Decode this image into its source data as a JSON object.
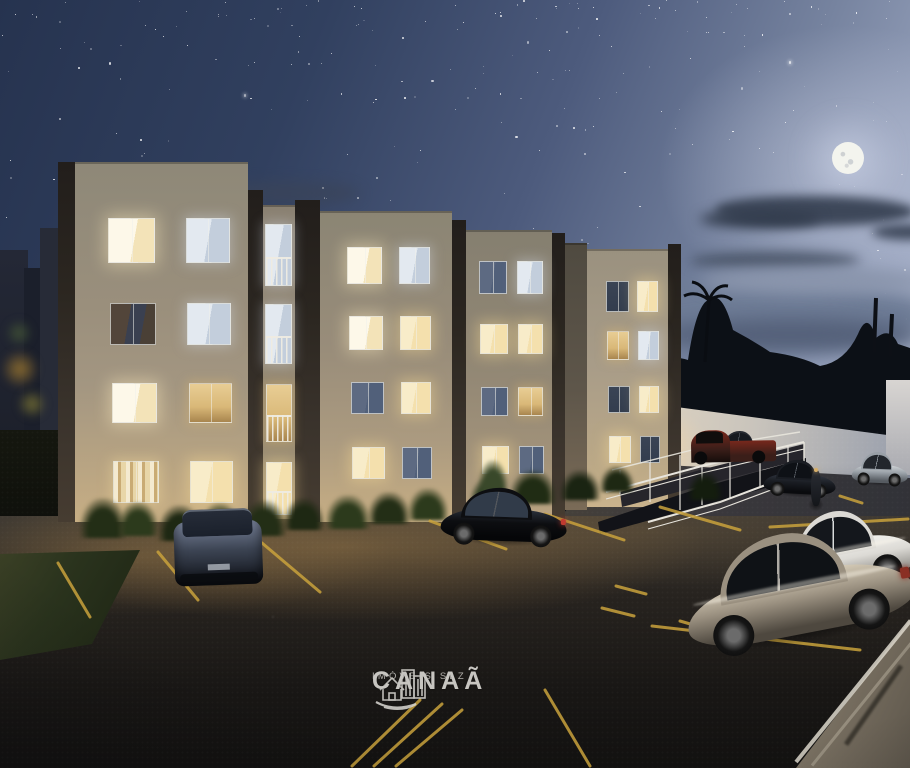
{
  "watermark": {
    "brand": "CANAÃ",
    "tagline": "IMÓVEIS SLZ",
    "icon": "canaa-city-house-logo"
  },
  "palette": {
    "sky-top": "#26334f",
    "sky-mid": "#4d5b7d",
    "sky-light": "#9aa5bf",
    "moon": "#f3f4ee",
    "cloud-dark": "#3d4759",
    "cloud-haze": "#6e7c96",
    "facade-top": "#8e8878",
    "facade-mid": "#a39681",
    "facade-warm": "#c7ae84",
    "facade-bay": "#8a8172",
    "facade-flank": "#5e564a",
    "facade-right": "#a89c88",
    "pillar-dark": "#2b2620",
    "pillar-light": "#463c31",
    "wall-warm": "#e4d5bb",
    "wall-mid": "#c9c4bc",
    "wall-cool": "#959cab",
    "treeline": "#0c1016",
    "asphalt": "#27231f",
    "asphalt-low": "#121110",
    "glow-warm": "#c49654",
    "line-yellow": "#c9a23c",
    "grass": "#2a331d",
    "railing": "#e8e5dd",
    "watermark": "#d5d3ce",
    "win-bright": "#fdf8e9",
    "win-warm": "#f4e0ad",
    "win-amber": "#d9b878",
    "win-pale": "#e3e9f0",
    "win-dim": "#51607a",
    "win-dark": "#333d4e",
    "win-reflect": "#4a4036"
  },
  "sky": {
    "stars": 240,
    "seed": 97,
    "moon": {
      "x": 848,
      "y": 158,
      "r": 16
    }
  },
  "building": {
    "facades": [
      {
        "x": 75,
        "y": 162,
        "w": 173,
        "h": 360,
        "cls": "f-a"
      },
      {
        "x": 263,
        "y": 205,
        "w": 32,
        "h": 314,
        "cls": "f-bay"
      },
      {
        "x": 320,
        "y": 211,
        "w": 132,
        "h": 311,
        "cls": "f-b1"
      },
      {
        "x": 466,
        "y": 230,
        "w": 86,
        "h": 292,
        "cls": "f-b2"
      },
      {
        "x": 565,
        "y": 243,
        "w": 22,
        "h": 267,
        "cls": "f-flank"
      },
      {
        "x": 587,
        "y": 249,
        "w": 81,
        "h": 258,
        "cls": "f-c"
      }
    ],
    "pillars": [
      {
        "x": 58,
        "y": 162,
        "w": 17,
        "h": 360
      },
      {
        "x": 248,
        "y": 190,
        "w": 15,
        "h": 330
      },
      {
        "x": 295,
        "y": 200,
        "w": 25,
        "h": 322
      },
      {
        "x": 452,
        "y": 220,
        "w": 14,
        "h": 302
      },
      {
        "x": 552,
        "y": 233,
        "w": 13,
        "h": 287
      },
      {
        "x": 668,
        "y": 244,
        "w": 13,
        "h": 260
      }
    ],
    "blocks": [
      {
        "name": "block-a",
        "windows": [
          {
            "y": 218,
            "h": 45,
            "cells": [
              {
                "x": 108,
                "w": 47,
                "state": "w-bright"
              },
              {
                "x": 186,
                "w": 44,
                "state": "w-pale"
              }
            ]
          },
          {
            "y": 303,
            "h": 42,
            "cells": [
              {
                "x": 110,
                "w": 46,
                "state": "w-reflect"
              },
              {
                "x": 187,
                "w": 44,
                "state": "w-pale"
              }
            ]
          },
          {
            "y": 383,
            "h": 40,
            "cells": [
              {
                "x": 112,
                "w": 45,
                "state": "w-bright"
              },
              {
                "x": 189,
                "w": 43,
                "state": "w-amber"
              }
            ]
          },
          {
            "y": 461,
            "h": 42,
            "cells": [
              {
                "x": 113,
                "w": 46,
                "state": "w-curtain"
              },
              {
                "x": 190,
                "w": 43,
                "state": "w-warm"
              }
            ]
          }
        ]
      },
      {
        "name": "balcony-bay",
        "windows": [
          {
            "y": 224,
            "h": 62,
            "cells": [
              {
                "x": 265,
                "w": 27,
                "state": "w-pale",
                "type": "door"
              }
            ]
          },
          {
            "y": 304,
            "h": 60,
            "cells": [
              {
                "x": 265,
                "w": 27,
                "state": "w-pale",
                "type": "door"
              }
            ]
          },
          {
            "y": 384,
            "h": 58,
            "cells": [
              {
                "x": 266,
                "w": 26,
                "state": "w-amber",
                "type": "door"
              }
            ]
          },
          {
            "y": 462,
            "h": 53,
            "cells": [
              {
                "x": 266,
                "w": 26,
                "state": "w-warm",
                "type": "door"
              }
            ]
          }
        ]
      },
      {
        "name": "block-b1",
        "windows": [
          {
            "y": 247,
            "h": 37,
            "cells": [
              {
                "x": 347,
                "w": 35,
                "state": "w-bright"
              },
              {
                "x": 399,
                "w": 31,
                "state": "w-pale"
              }
            ]
          },
          {
            "y": 316,
            "h": 34,
            "cells": [
              {
                "x": 349,
                "w": 34,
                "state": "w-bright"
              },
              {
                "x": 400,
                "w": 31,
                "state": "w-warm"
              }
            ]
          },
          {
            "y": 382,
            "h": 32,
            "cells": [
              {
                "x": 351,
                "w": 33,
                "state": "w-dim"
              },
              {
                "x": 401,
                "w": 30,
                "state": "w-warm"
              }
            ]
          },
          {
            "y": 447,
            "h": 32,
            "cells": [
              {
                "x": 352,
                "w": 33,
                "state": "w-warm"
              },
              {
                "x": 402,
                "w": 30,
                "state": "w-dim"
              }
            ]
          }
        ]
      },
      {
        "name": "block-b2",
        "windows": [
          {
            "y": 261,
            "h": 33,
            "cells": [
              {
                "x": 479,
                "w": 28,
                "state": "w-dim"
              },
              {
                "x": 517,
                "w": 26,
                "state": "w-pale"
              }
            ]
          },
          {
            "y": 324,
            "h": 30,
            "cells": [
              {
                "x": 480,
                "w": 28,
                "state": "w-warm"
              },
              {
                "x": 518,
                "w": 25,
                "state": "w-warm"
              }
            ]
          },
          {
            "y": 387,
            "h": 29,
            "cells": [
              {
                "x": 481,
                "w": 27,
                "state": "w-dim"
              },
              {
                "x": 518,
                "w": 25,
                "state": "w-amber"
              }
            ]
          },
          {
            "y": 446,
            "h": 28,
            "cells": [
              {
                "x": 482,
                "w": 27,
                "state": "w-warm"
              },
              {
                "x": 519,
                "w": 25,
                "state": "w-dim"
              }
            ]
          }
        ]
      },
      {
        "name": "right-wing",
        "windows": [
          {
            "y": 281,
            "h": 31,
            "cells": [
              {
                "x": 606,
                "w": 23,
                "state": "w-dark"
              },
              {
                "x": 637,
                "w": 21,
                "state": "w-warm"
              }
            ]
          },
          {
            "y": 331,
            "h": 29,
            "cells": [
              {
                "x": 607,
                "w": 22,
                "state": "w-amber"
              },
              {
                "x": 638,
                "w": 21,
                "state": "w-pale"
              }
            ]
          },
          {
            "y": 386,
            "h": 27,
            "cells": [
              {
                "x": 608,
                "w": 22,
                "state": "w-dark"
              },
              {
                "x": 639,
                "w": 20,
                "state": "w-warm"
              }
            ]
          },
          {
            "y": 436,
            "h": 27,
            "cells": [
              {
                "x": 609,
                "w": 22,
                "state": "w-warm"
              },
              {
                "x": 640,
                "w": 20,
                "state": "w-dark"
              }
            ]
          }
        ]
      }
    ]
  },
  "parking": {
    "stroke": 3,
    "lines": [
      [
        58,
        563,
        90,
        617
      ],
      [
        158,
        552,
        198,
        600
      ],
      [
        262,
        543,
        320,
        592
      ],
      [
        430,
        521,
        506,
        549
      ],
      [
        545,
        514,
        624,
        540
      ],
      [
        660,
        507,
        740,
        530
      ],
      [
        770,
        527,
        908,
        519
      ],
      [
        652,
        626,
        860,
        650
      ],
      [
        616,
        586,
        646,
        594
      ],
      [
        602,
        608,
        634,
        616
      ],
      [
        680,
        621,
        704,
        628
      ],
      [
        840,
        496,
        862,
        503
      ],
      [
        545,
        690,
        590,
        766
      ],
      [
        352,
        766,
        420,
        700
      ],
      [
        374,
        766,
        442,
        704
      ],
      [
        396,
        766,
        462,
        710
      ]
    ]
  },
  "cars": [
    {
      "name": "hatchback-rear",
      "type": "rear",
      "x": 174,
      "y": 503,
      "w": 88,
      "h": 82,
      "rot": -2,
      "body": "#3c4453",
      "roof": "#79839a",
      "glass": "#1a202b",
      "dark": "#12151c"
    },
    {
      "name": "black-sedan",
      "type": "side",
      "x": 441,
      "y": 488,
      "w": 126,
      "h": 56,
      "rot": 2,
      "body": "#0d0e11",
      "roof": "#2a303b",
      "glass": "#313b49",
      "dark": "#050608",
      "tail": "#c03a30"
    },
    {
      "name": "pickup-truck",
      "type": "pickup",
      "x": 681,
      "y": 424,
      "w": 95,
      "h": 38,
      "rot": -1,
      "body": "#3a1e19",
      "roof": "#1c1512",
      "glass": "#100d0c",
      "dark": "#150d0b",
      "accent": "#77281c"
    },
    {
      "name": "dark-suv",
      "type": "side",
      "x": 716,
      "y": 431,
      "w": 52,
      "h": 28,
      "rot": 0,
      "body": "#262a31",
      "roof": "#454b55",
      "glass": "#161a20",
      "dark": "#0e1014"
    },
    {
      "name": "silver-sedan-far",
      "type": "side",
      "x": 852,
      "y": 452,
      "w": 56,
      "h": 33,
      "rot": 2,
      "body": "#99a0a7",
      "roof": "#cfd3d6",
      "glass": "#22262c",
      "dark": "#565b61"
    },
    {
      "name": "dark-sedan-mid",
      "type": "side",
      "x": 764,
      "y": 460,
      "w": 72,
      "h": 36,
      "rot": 3,
      "body": "#1a1d23",
      "roof": "#313742",
      "glass": "#0e1116",
      "dark": "#0a0b0e"
    },
    {
      "name": "white-sedan",
      "type": "side",
      "x": 775,
      "y": 510,
      "w": 140,
      "h": 80,
      "rot": -11,
      "body": "#dcdad5",
      "roof": "#f2f1ed",
      "glass": "#14171c",
      "dark": "#8f8d88",
      "shine": true
    },
    {
      "name": "champagne-sedan",
      "type": "side",
      "x": 682,
      "y": 532,
      "w": 230,
      "h": 108,
      "rot": -11,
      "body": "#9a9080",
      "roof": "#d6ccb8",
      "glass": "#0f1216",
      "dark": "#4e483f",
      "shine": true,
      "tail": "#8a2f24"
    },
    {
      "name": "motorcycle",
      "type": "moto",
      "x": 806,
      "y": 466,
      "w": 20,
      "h": 44,
      "rot": 0,
      "body": "#14161a",
      "dark": "#0a0b0d"
    }
  ],
  "plants": [
    [
      80,
      498,
      46,
      40,
      "#232e16"
    ],
    [
      118,
      502,
      40,
      34,
      "#2c3a1c"
    ],
    [
      158,
      505,
      44,
      36,
      "#1e2813"
    ],
    [
      200,
      503,
      40,
      34,
      "#2c3a1c"
    ],
    [
      242,
      500,
      44,
      36,
      "#232e16"
    ],
    [
      284,
      498,
      40,
      32,
      "#1e2813"
    ],
    [
      326,
      495,
      44,
      34,
      "#2c3a1c"
    ],
    [
      368,
      492,
      42,
      32,
      "#232e16"
    ],
    [
      408,
      488,
      40,
      32,
      "#2c3a1c"
    ],
    [
      470,
      478,
      36,
      30,
      "#2a3a20"
    ],
    [
      478,
      460,
      30,
      36,
      "#39482a"
    ],
    [
      510,
      470,
      46,
      34,
      "#202c14"
    ],
    [
      560,
      470,
      40,
      30,
      "#1a2412"
    ],
    [
      600,
      466,
      34,
      26,
      "#1e2813"
    ],
    [
      688,
      472,
      34,
      28,
      "#141d0e"
    ]
  ]
}
